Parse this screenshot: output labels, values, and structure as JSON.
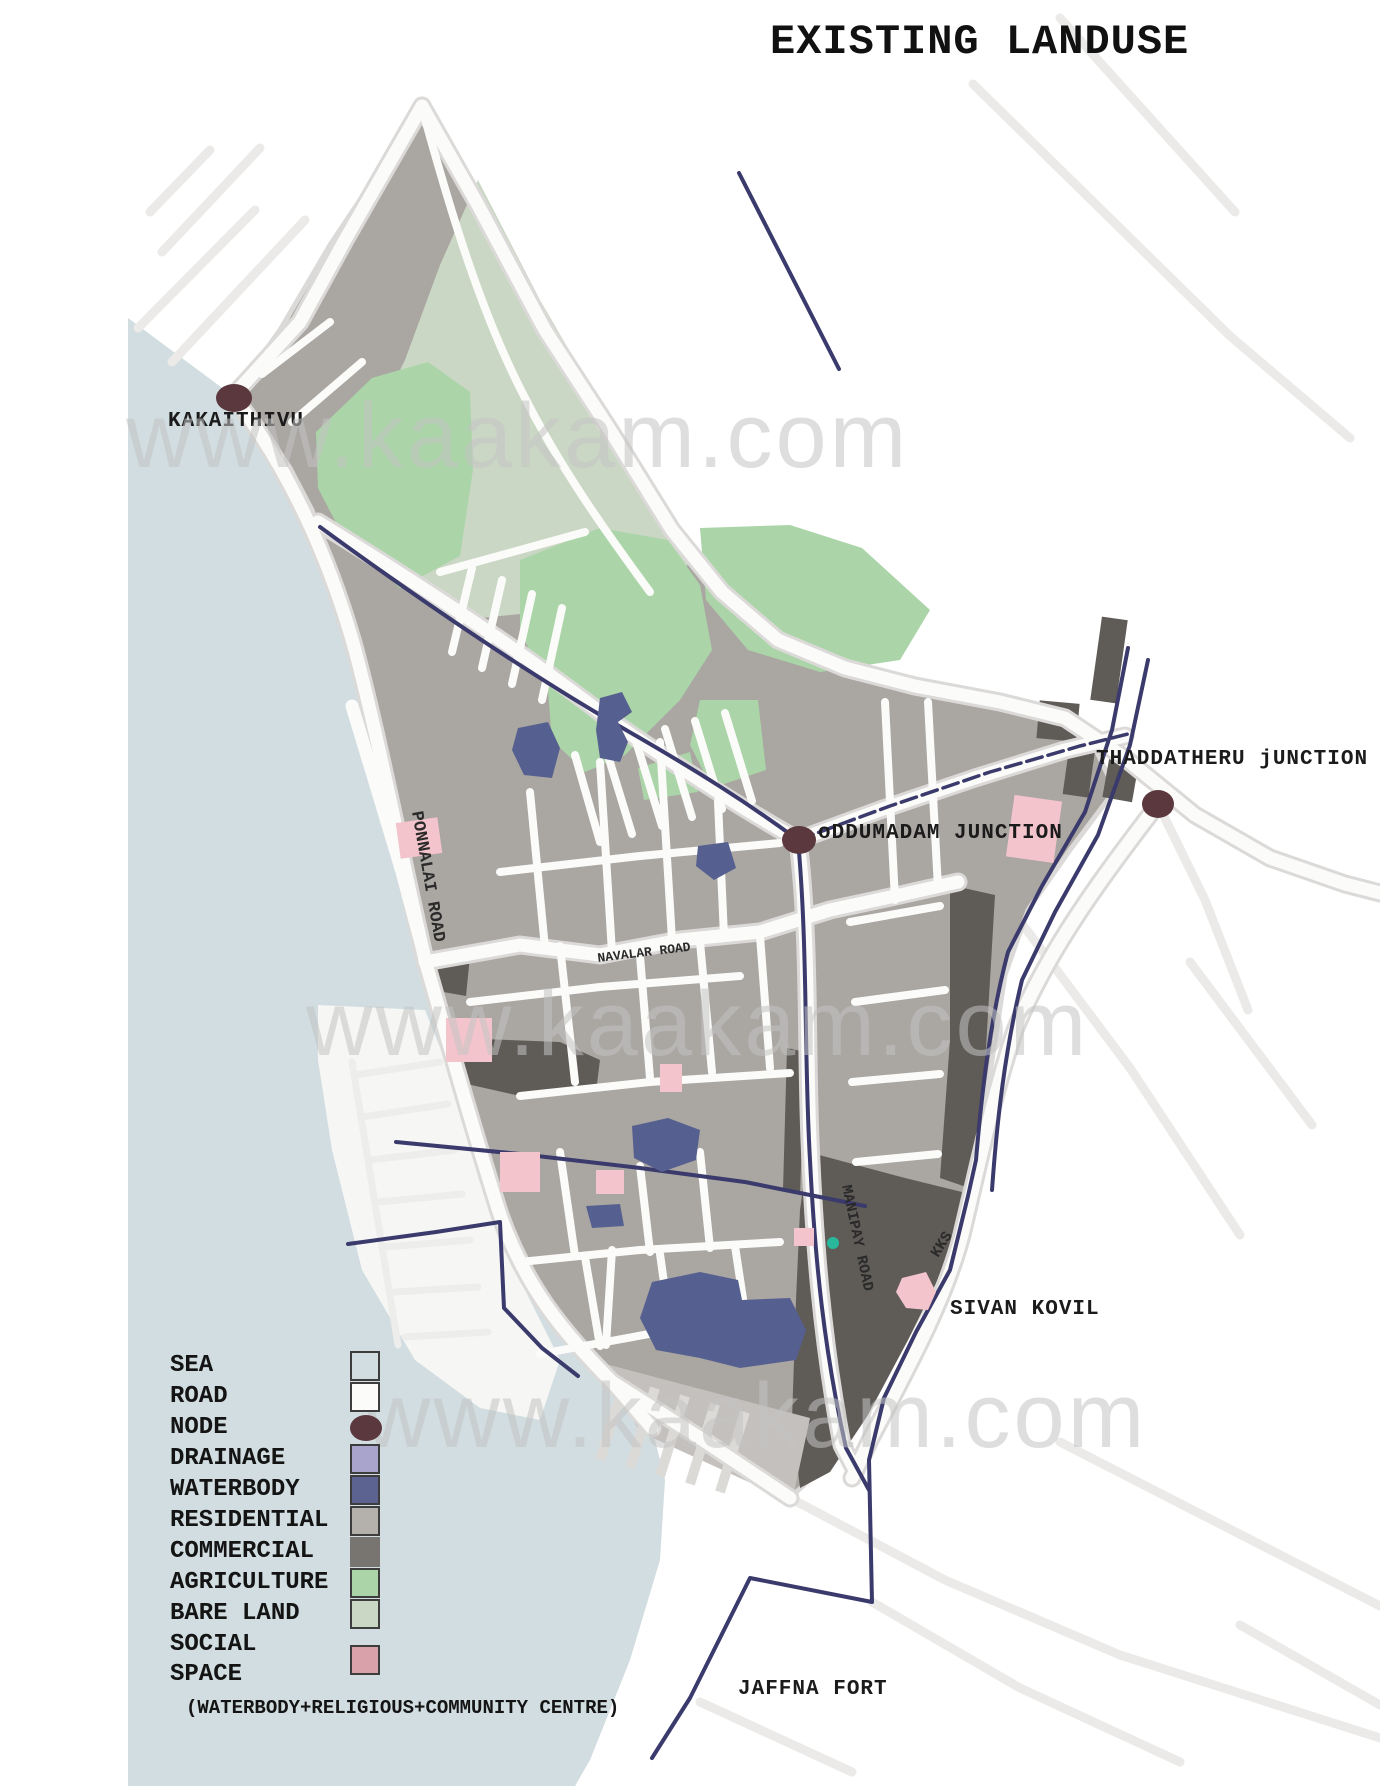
{
  "header": {
    "title": "EXISTING LANDUSE"
  },
  "watermark": {
    "text": "www.kaakam.com"
  },
  "palette": {
    "sea": "#d1dde0",
    "lagoon": "#f6f6f4",
    "land": "#aaa6a2",
    "bareland": "#cbd7c5",
    "agriculture": "#abd5a8",
    "commercial": "#5f5b57",
    "waterbody": "#566090",
    "drainage": "#3a3a6c",
    "node": "#5a383e",
    "social": "#f3c4cb",
    "teal": "#29b99a",
    "road": "#fbfbf9",
    "road-casing": "#dcdad8",
    "faint-road": "#ebeae8",
    "buildings-base": "#c3c0bd",
    "buildings-strip": "#dcdad7",
    "watermark": "#c4c4c4",
    "text": "#1b1b1b"
  },
  "legend": {
    "items": [
      {
        "label": "SEA",
        "color": "#d1dde0",
        "shape": "swatch"
      },
      {
        "label": "ROAD",
        "color": "#fbfbf9",
        "shape": "swatch"
      },
      {
        "label": "NODE",
        "color": "#5a383e",
        "shape": "node"
      },
      {
        "label": "DRAINAGE",
        "color": "#a9a4cc",
        "shape": "swatch"
      },
      {
        "label": "WATERBODY",
        "color": "#5c6390",
        "shape": "swatch"
      },
      {
        "label": "RESIDENTIAL",
        "color": "#b4b0ab",
        "shape": "swatch"
      },
      {
        "label": "COMMERCIAL",
        "color": "#787470",
        "shape": "swatch-noborder"
      },
      {
        "label": "AGRICULTURE",
        "color": "#abd5a8",
        "shape": "swatch"
      },
      {
        "label": "BARE LAND",
        "color": "#cbd7c5",
        "shape": "swatch"
      },
      {
        "label": "SOCIAL",
        "label2": "SPACE",
        "color": "#d9a2ab",
        "shape": "swatch"
      }
    ],
    "note": "(WATERBODY+RELIGIOUS+COMMUNITY CENTRE)"
  },
  "map": {
    "labels": {
      "kakaithivu": "KAKAITHIVU",
      "oddumadam": "oDDUMADAM JUNCTION",
      "thaddatheru": "THADDATHERU jUNCTION",
      "sivan_kovil": "SIVAN KOVIL",
      "jaffna_fort": "JAFFNA FORT"
    },
    "road_labels": {
      "ponnalai": "PONNALAI ROAD",
      "navalar": "NAVALAR ROAD",
      "manipay": "MANIPAY ROAD",
      "kks": "KKS"
    }
  }
}
